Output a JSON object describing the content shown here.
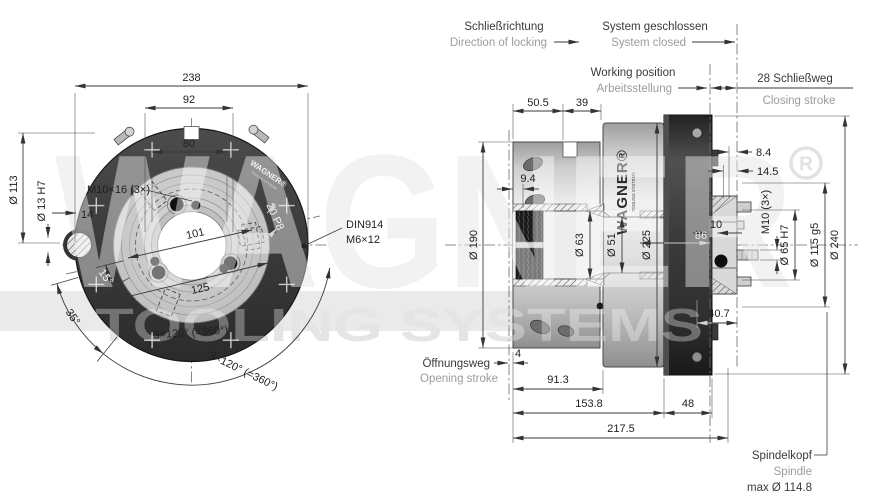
{
  "watermark": {
    "brand": "WAGNER",
    "registered_symbol": "R",
    "tagline": "TOOLING SYSTEMS"
  },
  "front_view": {
    "dim_238": "238",
    "dim_92": "92",
    "dim_80": "80",
    "dim_d113": "Ø 113",
    "dim_d13h7": "Ø 13 H7",
    "dim_14": "14",
    "label_m10x16": "M10×16 (3×)",
    "dim_101": "101",
    "label_20p8": "20 P8",
    "din914_line1": "DIN914",
    "din914_line2": "M6×12",
    "dim_15deg": "15°",
    "dim_125": "125",
    "dim_35deg": "35°",
    "dim_3x120_inner": "3×120° (=360°)",
    "dim_3x120_outer": "3×120° (=360°)",
    "ring_logo": "WAGNER®",
    "ring_logo_tagline": "TOOLING SYSTEMS"
  },
  "side_view": {
    "labels": {
      "schliessrichtung_de": "Schließrichtung",
      "schliessrichtung_en": "Direction of locking",
      "system_geschlossen_de": "System geschlossen",
      "system_geschlossen_en": "System closed",
      "working_position_en": "Working position",
      "working_position_de": "Arbeitsstellung",
      "schliessweg": "28 Schließweg",
      "closing_stroke": "Closing stroke",
      "oeffnungsweg_de": "Öffnungsweg",
      "oeffnungsweg_en": "Opening stroke",
      "spindelkopf_de": "Spindelkopf",
      "spindelkopf_en": "Spindle",
      "spindelkopf_max": "max Ø 114.8"
    },
    "dims": {
      "d50_5": "50.5",
      "d39": "39",
      "d9_4": "9.4",
      "d190": "Ø 190",
      "d63": "Ø 63",
      "d51": "Ø 51",
      "d225": "Ø 225",
      "d8_4": "8.4",
      "d14_5": "14.5",
      "d10": "10",
      "d86": "86",
      "m10_3x": "M10 (3×)",
      "d65h7": "Ø 65 H7",
      "d115g5": "Ø 115 g5",
      "d240": "Ø 240",
      "d40_7": "40.7",
      "d4": "4",
      "d91_3": "91.3",
      "d153_8": "153.8",
      "d48": "48",
      "d217_5": "217.5"
    },
    "body_logo": "WAGNER®",
    "body_logo_tagline": "TOOLING SYSTEMS"
  },
  "colors": {
    "dark_part": "#3b3b3b",
    "light_part": "#d8d8d8",
    "dim_line": "#3a3a3a",
    "annotation_de": "#3a3a3a",
    "annotation_en": "#9c9c9c",
    "watermark": "#e9e9e9"
  }
}
